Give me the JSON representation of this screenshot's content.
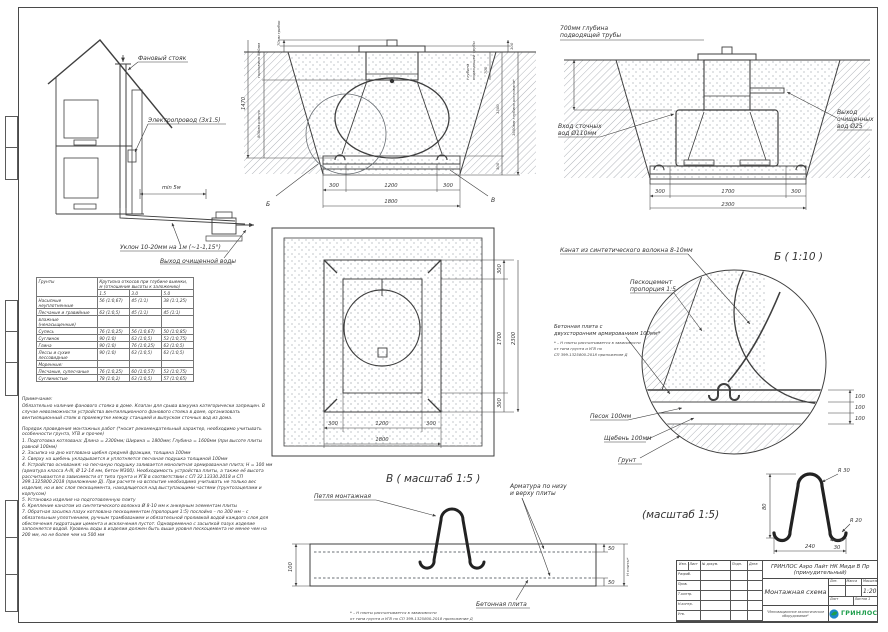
{
  "colors": {
    "line": "#3f3f3f",
    "hatch": "#a8adb3",
    "logo_green": "#1e9e4c",
    "logo_blue": "#1d86c8"
  },
  "house_view": {
    "vent_stack": "Фановый стояк",
    "electric": "Электропровод (3x1.5)",
    "min_dist": "min 5м",
    "slope": "Уклон 10-20мм на 1м (~1-1,15°)",
    "outlet": "Выход очищенной воды"
  },
  "pit_side": {
    "cap": "70мм грибок",
    "neck": "горловина 600мм",
    "total_h": "1470",
    "body": "800мм корпус",
    "pipe_depth_label": [
      "глубина",
      "подводящей трубы"
    ],
    "d100": "100",
    "d700": "700",
    "d1300": "1300",
    "d300": "300",
    "pit_depth": "1600мм глубина котлована*",
    "bottom": [
      "300",
      "1200",
      "300",
      "1800"
    ],
    "callout_b": "Б",
    "callout_v": "В"
  },
  "pit_front": {
    "pipe_depth": [
      "700мм глубина",
      "подводящей трубы"
    ],
    "inlet": [
      "Вход сточных",
      "вод Ø110мм"
    ],
    "outlet": [
      "Выход",
      "очищенных",
      "вод Ø25"
    ],
    "bottom": [
      "300",
      "1700",
      "300",
      "2300"
    ]
  },
  "plan": {
    "right": [
      "300",
      "1700",
      "300",
      "2300"
    ],
    "bottom": [
      "300",
      "1200",
      "300",
      "1800"
    ]
  },
  "detail_b": {
    "title": "Б ( 1:10 )",
    "rope": "Канат из синтетического волокна 8-10мм",
    "sandcement": [
      "Пескоцемент",
      "пропорция 1:5"
    ],
    "slab": [
      "Бетонная плита с",
      "двухсторонним армированием 100мм*"
    ],
    "footnote": [
      "* – Н плиты рассчитывается в зависимости",
      "от типа грунта и УГВ по",
      "СП 399.1325800.2018 приложение Д"
    ],
    "sand": "Песок 100мм",
    "gravel": "Щебень 100мм",
    "soil": "Грунт",
    "d": [
      "100",
      "100",
      "100"
    ]
  },
  "slope_table": {
    "col_soil": "Грунты",
    "col_main": "Крутизна откосов при глубине выемки, м (отношение высоты к заложению)",
    "depths": [
      "1.5",
      "3.0",
      "5.0"
    ],
    "rows": [
      {
        "name": "Насыпные неуплотненные",
        "c1": "56 (1:0,67)",
        "c2": "45 (1:1)",
        "c3": "38 (1:1,25)"
      },
      {
        "name": "Песчаные и гравийные",
        "c1": "63 (1:0,5)",
        "c2": "45 (1:1)",
        "c3": "45 (1:1)"
      },
      {
        "name": "влажные (ненасыщенные)",
        "c1": "",
        "c2": "",
        "c3": ""
      },
      {
        "name": "Супесь",
        "c1": "76 (1:0,25)",
        "c2": "56 (1:0,67)",
        "c3": "50 (1:0,85)"
      },
      {
        "name": "Суглинок",
        "c1": "90 (1:0)",
        "c2": "63 (1:0,5)",
        "c3": "53 (1:0,75)"
      },
      {
        "name": "Глина",
        "c1": "90 (1:0)",
        "c2": "76 (1:0,25)",
        "c3": "63 (1:0,5)"
      },
      {
        "name": "Лессы и сухие лессовидные",
        "c1": "90 (1:0)",
        "c2": "63 (1:0,5)",
        "c3": "63 (1:0,5)"
      },
      {
        "name": "Моренные:",
        "c1": "",
        "c2": "",
        "c3": ""
      },
      {
        "name": "Песчаные, супесчаные",
        "c1": "76 (1:0,25)",
        "c2": "60 (1:0,57)",
        "c3": "53 (1:0,75)"
      },
      {
        "name": "Суглинистые",
        "c1": "78 (1:0,2)",
        "c2": "63 (1:0,5)",
        "c3": "57 (1:0,65)"
      }
    ]
  },
  "notes": {
    "title": "Примечание:",
    "p1": "Обязательно наличие фанового стояка в доме. Клапан для срыва вакуума категорически запрещен. В случае невозможности устройства вентиляционного фанового стояка в доме, организовать вентиляционный стояк в промежутке между станцией и выпуском сточных вод из дома.",
    "p2": "Порядок проведения монтажных работ (*носит рекомендательный характер, необходимо учитывать особенности грунта, УГВ и прочее)",
    "items": [
      "1. Подготовка котлована: Длина = 2300мм;  Ширина = 1800мм;  Глубина = 1600мм (при высоте плиты равной 100мм)",
      "2. Засыпка на дно котлована щебня средней фракции, толщина 100мм",
      "3. Сверху на щебень укладывается и уплотняется песчаная подушка толщиной 100мм",
      "4. Устройство основания: на песчаную подушку заливается монолитная армированная плита; Н = 100 мм (арматура класса А-III, Ø 12-14 мм, бетон М300). Необходимость устройства плиты, а также её высота рассчитываются в зависимости от типа грунта и УГВ в соответствии с СП 32.13330.2018 и СП 399.1325800.2018 (приложение Д). При расчете на всплытие необходимо учитывать не только вес изделия, но и вес слоя пескоцемента, находящегося над выступающими частями (грунтозацепами и корпусом)",
      "5. Установка изделия на подготовленную плиту",
      "6. Крепление канатом из синтетического волокна Ø 8-10 мм к анкерным элементам плиты",
      "7. Обратная засыпка пазух котлована пескоцементом (пропорция 1:5) послойно – по 300 мм – с обязательным уплотнением, ручным трамбованием и обязательной проливкой водой каждого слоя для обеспечения гидратации цемента и исключения пустот. Одновременно с засыпкой пазух изделие заполняется водой. Уровень воды в изделии должен быть выше уровня пескоцемента не менее чем на 200 мм, но не более чем на 500 мм"
    ]
  },
  "detail_v": {
    "title": "В ( масштаб 1:5 )",
    "loop": "Петля монтажная",
    "rebar": [
      "Арматура по низу",
      "и верху плиты"
    ],
    "slab": "Бетонная плита",
    "footnote": [
      "* – Н плиты рассчитывается в зависимости",
      "от типа грунта и УГВ по СП 399.1325800.2018 приложение Д"
    ],
    "d_left": "100",
    "d_top": "50",
    "d_bot": "50",
    "h_label": "Н плиты*"
  },
  "loop_detail": {
    "scale": "(масштаб 1:5)",
    "r30": "R 30",
    "r20": "R 20",
    "d80": "80",
    "d30": "30",
    "d240": "240"
  },
  "title_block": {
    "doc_title": "ГРИНЛОС Аэро Лайт НК Миди В Пр (принудительный)",
    "sheet_name": "Монтажная схема",
    "scale": "1:20",
    "col_izm": "Изм.",
    "col_list": "Лист",
    "col_doc": "№ докум.",
    "col_sign": "Подп.",
    "col_date": "Дата",
    "row_0": "Разраб.",
    "row_1": "Пров.",
    "row_2": "Т.контр.",
    "row_3": "Н.контр.",
    "row_4": "Утв.",
    "lit": "Лит.",
    "mass": "Масса",
    "masshtab": "Масштаб",
    "list": "Лист",
    "listov": "Листов 1",
    "tagline": "\"Инновационное экологическое оборудование\"",
    "logo": "ГРИНЛОС"
  }
}
